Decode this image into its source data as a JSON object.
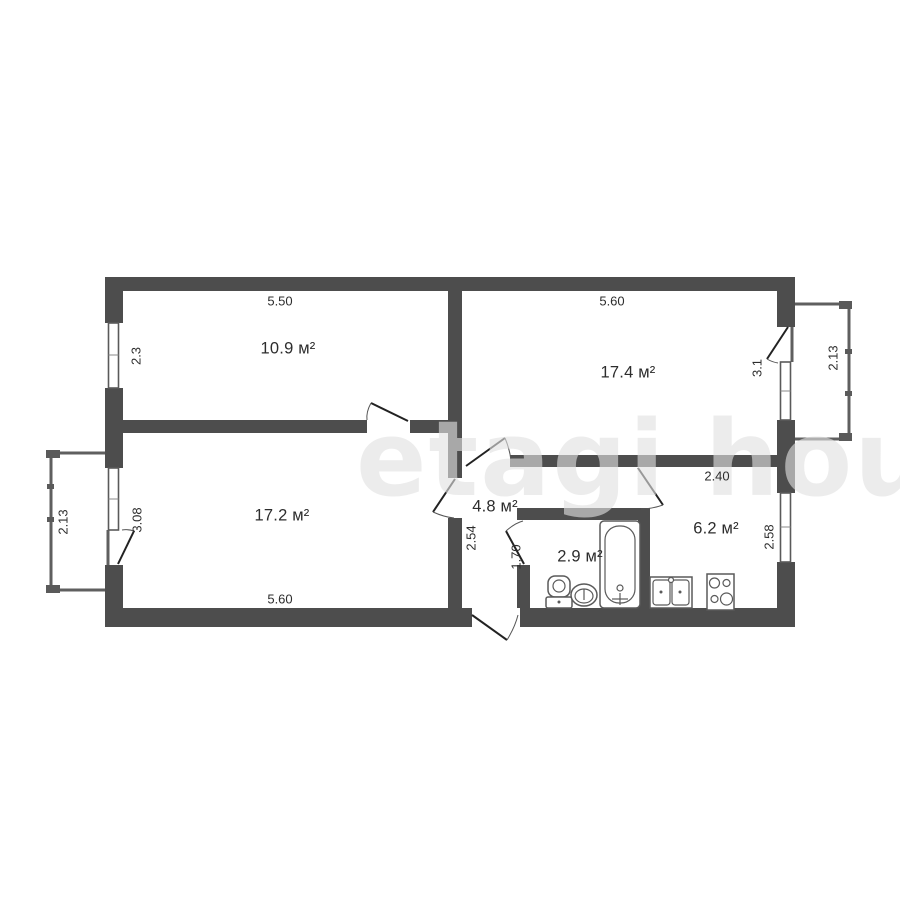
{
  "plan": {
    "watermark": "etagi house",
    "rooms": [
      {
        "id": "room-top-left",
        "area_label": "10.9 м²",
        "top_dim": "5.50",
        "window_dim": "2.3"
      },
      {
        "id": "room-top-right",
        "area_label": "17.4 м²",
        "top_dim": "5.60",
        "balcony_opening_dim": "3.1"
      },
      {
        "id": "room-bottom-left",
        "area_label": "17.2 м²",
        "bottom_dim": "5.60",
        "balcony_opening_dim": "3.08"
      },
      {
        "id": "hallway",
        "area_label": "4.8 м²",
        "depth_dim": "2.54"
      },
      {
        "id": "bathroom",
        "area_label": "2.9 м²",
        "door_wall_dim": "1.70"
      },
      {
        "id": "kitchen",
        "area_label": "6.2 м²",
        "width_dim": "2.40",
        "window_dim": "2.58"
      },
      {
        "id": "balcony-left",
        "length_dim": "2.13"
      },
      {
        "id": "balcony-right",
        "length_dim": "2.13"
      }
    ],
    "fixtures": [
      "bathtub",
      "toilet",
      "wash-basin",
      "kitchen-sink",
      "stove"
    ],
    "colors": {
      "wall": "#4d4d4d",
      "thin_line": "#5a5a5a",
      "door_line": "#222222",
      "arc_line": "#555555",
      "text": "#2d2d2d",
      "background": "#ffffff",
      "watermark": "#e1e1e1"
    }
  }
}
